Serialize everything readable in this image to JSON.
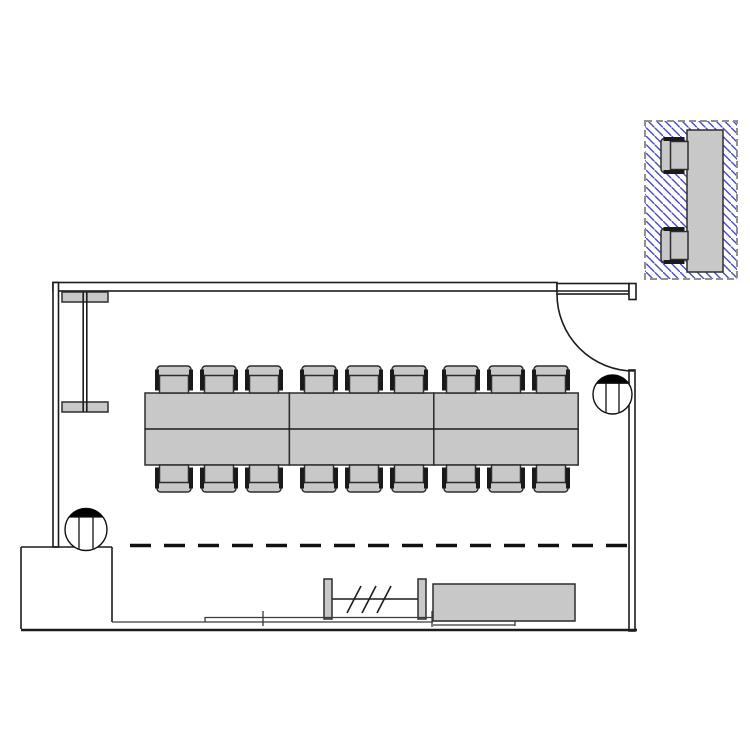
{
  "drawing": {
    "kind": "floor-plan",
    "background": "#ffffff"
  },
  "colors": {
    "line_dark": "#1c1c1c",
    "furniture_fill": "#c8c8c8",
    "furniture_stroke": "#2d2d2d",
    "armrest_dark": "#1a1a1a",
    "hatch_blue": "#4b4bc2",
    "inset_border_gray": "#919191",
    "band_gray": "#3a3a3a"
  },
  "floor_plan": {
    "walls": {
      "top": {
        "x": 53,
        "y": 282.5,
        "w": 504,
        "h": 8.5
      },
      "left": {
        "x": 53,
        "y": 282.5,
        "w": 5.5,
        "h": 264.5
      },
      "right": {
        "x": 629,
        "y": 370,
        "w": 6,
        "h": 261
      },
      "annex": {
        "top_line": [
          21,
          547,
          112,
          547
        ],
        "left_line": [
          21,
          547,
          21,
          629
        ],
        "inner_line": [
          112,
          547,
          112,
          622
        ],
        "bottom_wall": [
          21,
          630,
          637,
          630
        ]
      }
    },
    "door": {
      "leaf": {
        "x": 557,
        "y": 283.5,
        "w": 72,
        "h": 10.5
      },
      "leaf_inner_y": 291,
      "jamb": {
        "x": 629,
        "y": 283.5,
        "w": 7,
        "h": 16
      },
      "swing": {
        "cx": 634,
        "cy": 294,
        "r": 77,
        "start": [
          557,
          294
        ],
        "end": [
          634,
          371
        ]
      }
    },
    "opening_dashed_line": {
      "y": 545.5,
      "x1": 130,
      "x2": 628
    },
    "wall_unit": {
      "bar_top": {
        "x": 62,
        "y": 292,
        "w": 46,
        "h": 10
      },
      "bar_bottom": {
        "x": 62,
        "y": 402,
        "w": 46,
        "h": 10
      },
      "stem_x": [
        83.2,
        86.8
      ],
      "stem_y": [
        292,
        412
      ]
    },
    "tables": {
      "x": 145,
      "y": 393,
      "cols": 3,
      "col_w": 144.4,
      "h": 72,
      "midline_y": 429
    },
    "chairs": {
      "w": 38,
      "h": 27,
      "x_positions": [
        155,
        200,
        245,
        300,
        345,
        390,
        442,
        487,
        532
      ],
      "top_row_y": 366,
      "bottom_row_y": 465
    },
    "columns": [
      {
        "cx": 612.5,
        "cy": 394.5,
        "r": 19.5,
        "chord_offset": 8.2,
        "line_dx": 6.5
      },
      {
        "cx": 86,
        "cy": 529.5,
        "r": 21,
        "chord_offset": 8.5,
        "line_dx": 7
      }
    ],
    "partition": {
      "posts": [
        {
          "x": 324,
          "y": 579,
          "w": 8,
          "h": 40
        },
        {
          "x": 418,
          "y": 579,
          "w": 8,
          "h": 40
        }
      ],
      "rail": [
        332,
        599,
        418,
        599
      ],
      "slashes": [
        [
          347,
          613,
          361,
          586
        ],
        [
          362,
          613,
          376,
          586
        ],
        [
          377,
          613,
          391,
          586
        ]
      ]
    },
    "sideboard": {
      "x": 433,
      "y": 584,
      "w": 142,
      "h": 37
    },
    "window_band": {
      "lines": [
        [
          112,
          622,
          433,
          622
        ],
        [
          205,
          617.5,
          433,
          617.5
        ],
        [
          433,
          621,
          575,
          621
        ],
        [
          433,
          625,
          515,
          625
        ]
      ],
      "ticks": [
        [
          263,
          611,
          263,
          626
        ],
        [
          432,
          611,
          432,
          627
        ],
        [
          205,
          617,
          205,
          622
        ],
        [
          515,
          621,
          515,
          626
        ]
      ]
    }
  },
  "detail_inset": {
    "frame": {
      "x": 645,
      "y": 121,
      "w": 92,
      "h": 158
    },
    "table": {
      "x": 687,
      "y": 130,
      "w": 36,
      "h": 142
    },
    "chairs": {
      "x": 661,
      "depth": 27,
      "width": 37,
      "y_positions": [
        137,
        227
      ]
    },
    "hatch": {
      "direction": "backslash",
      "spacing": 8.5
    }
  }
}
